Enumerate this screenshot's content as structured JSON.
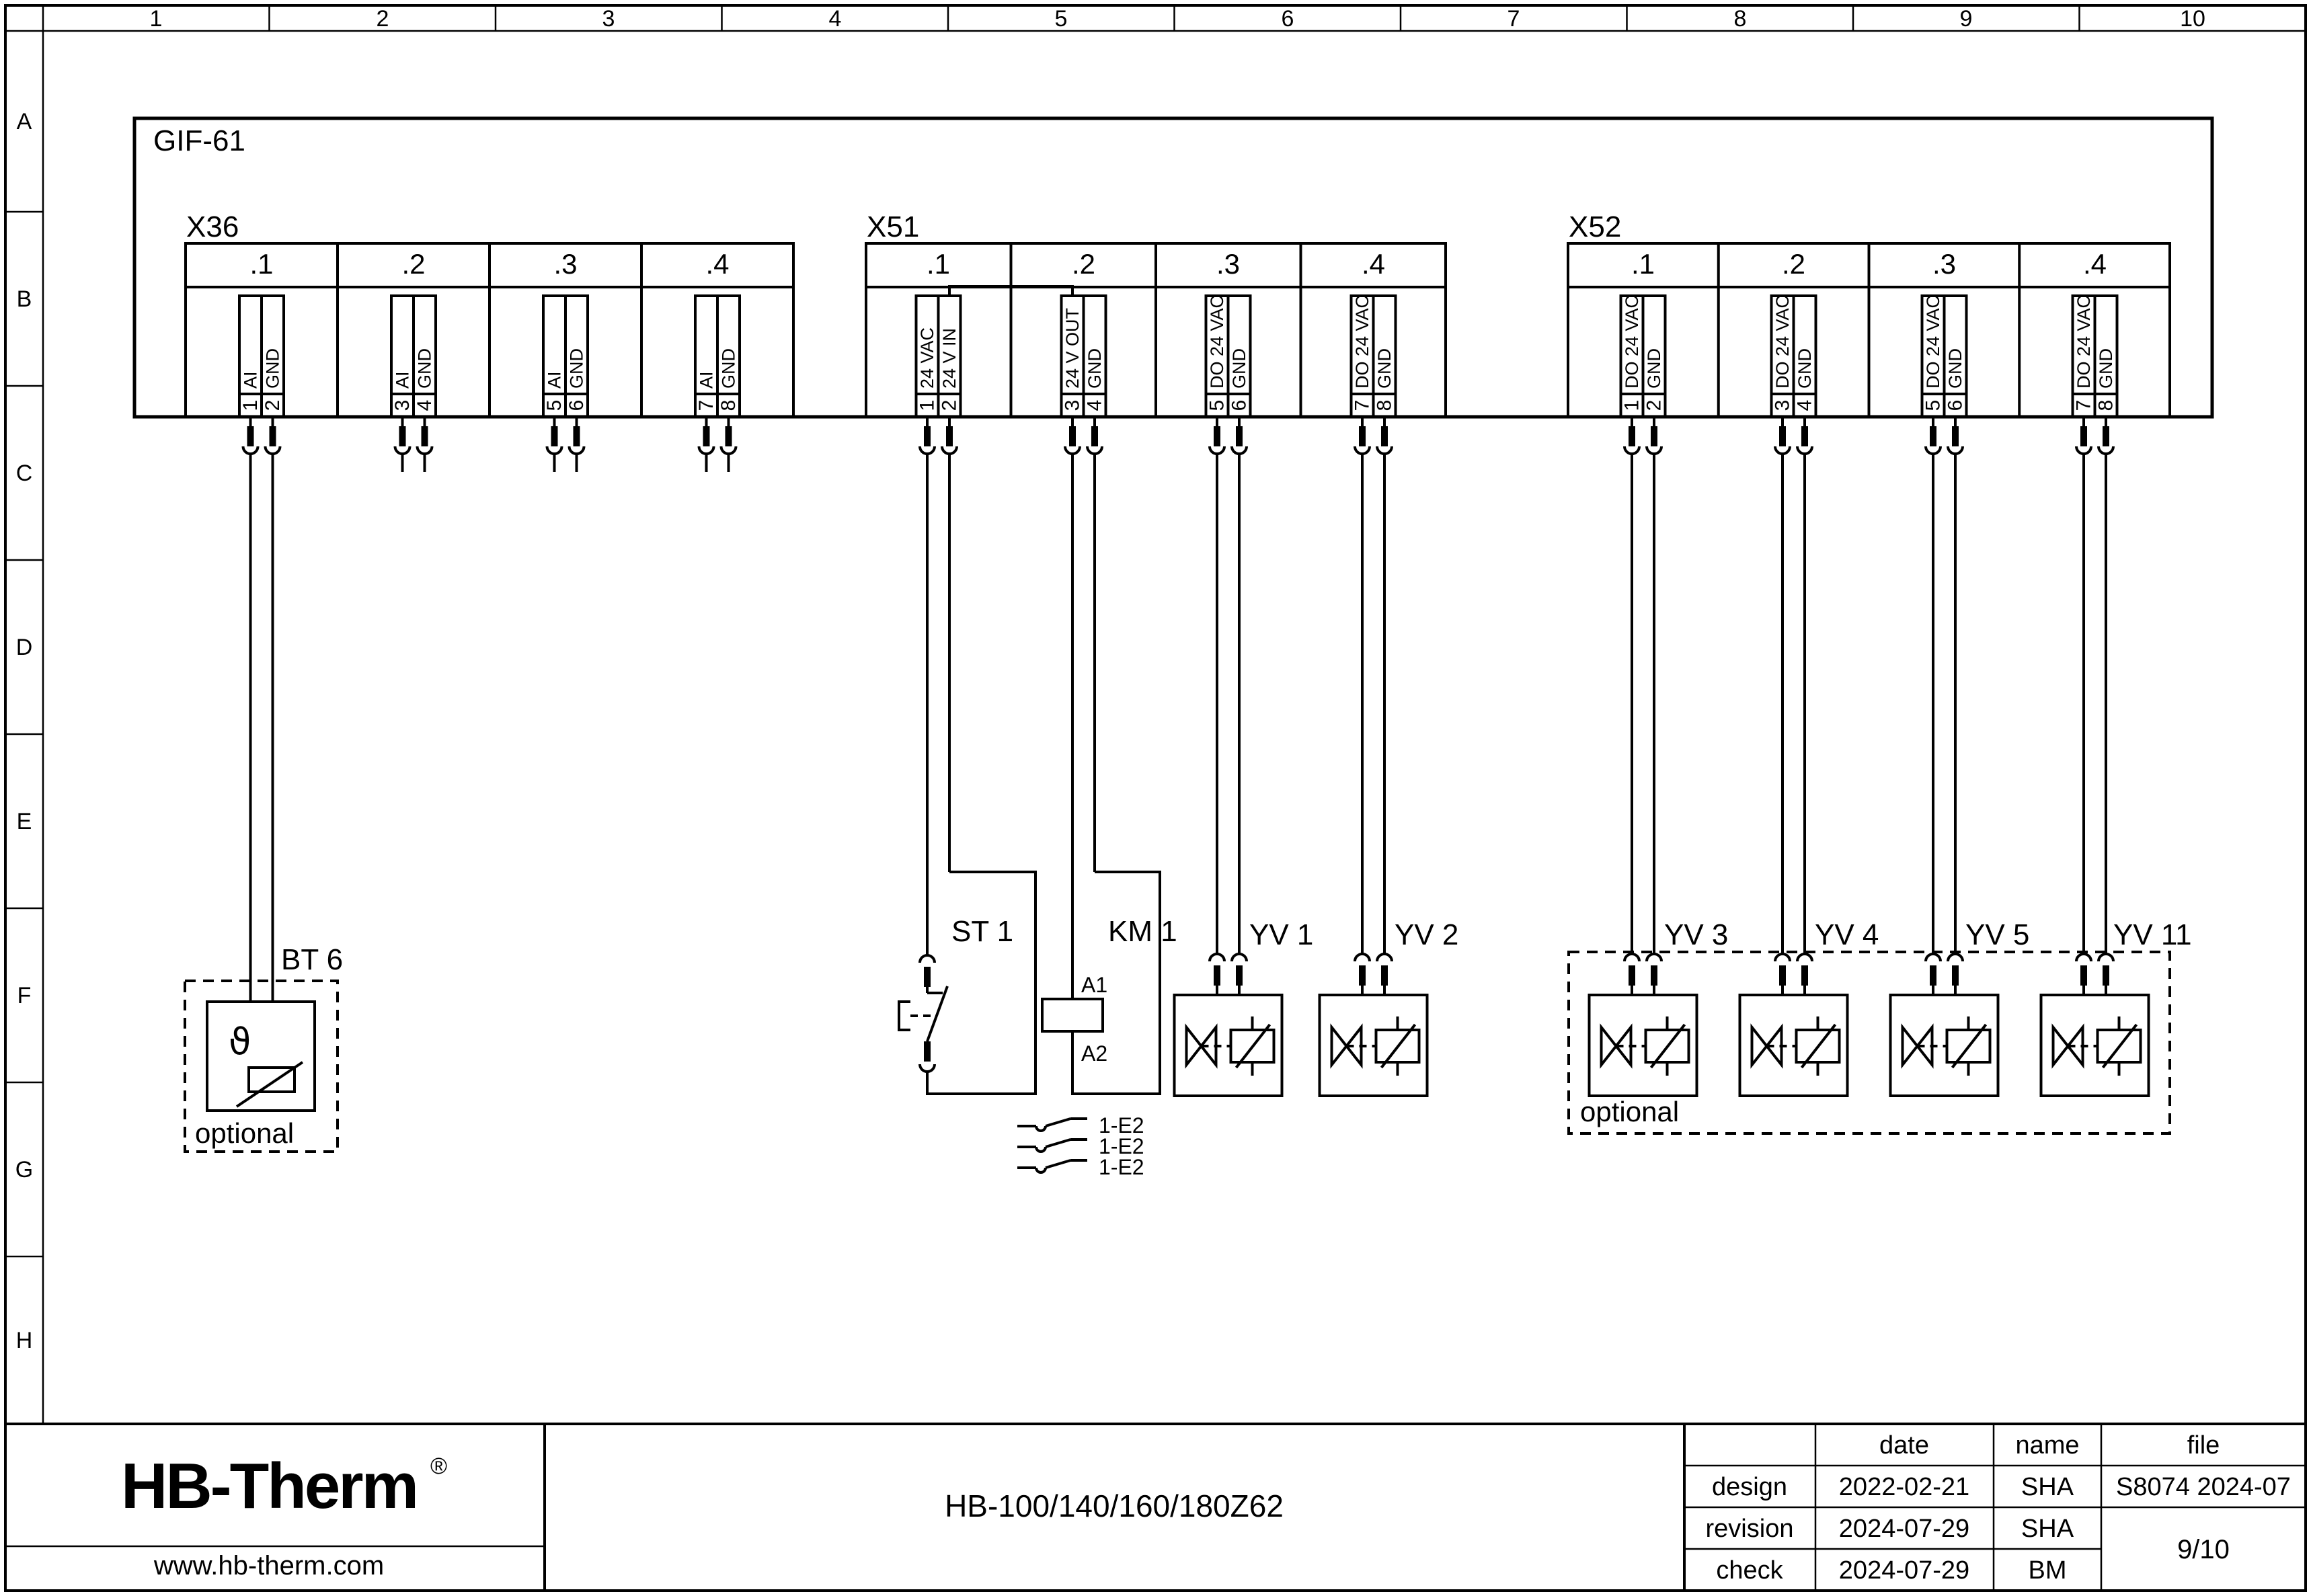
{
  "ruler": {
    "columns": [
      "1",
      "2",
      "3",
      "4",
      "5",
      "6",
      "7",
      "8",
      "9",
      "10"
    ],
    "rows": [
      "A",
      "B",
      "C",
      "D",
      "E",
      "F",
      "G",
      "H"
    ]
  },
  "module": {
    "label": "GIF-61"
  },
  "x36": {
    "label": "X36",
    "cells": [
      {
        "label": ".1"
      },
      {
        "label": ".2"
      },
      {
        "label": ".3"
      },
      {
        "label": ".4"
      }
    ],
    "pins": [
      {
        "no": "1",
        "signal": "AI"
      },
      {
        "no": "2",
        "signal": "GND"
      },
      {
        "no": "3",
        "signal": "AI"
      },
      {
        "no": "4",
        "signal": "GND"
      },
      {
        "no": "5",
        "signal": "AI"
      },
      {
        "no": "6",
        "signal": "GND"
      },
      {
        "no": "7",
        "signal": "AI"
      },
      {
        "no": "8",
        "signal": "GND"
      }
    ]
  },
  "x51": {
    "label": "X51",
    "cells": [
      {
        "label": ".1"
      },
      {
        "label": ".2"
      },
      {
        "label": ".3"
      },
      {
        "label": ".4"
      }
    ],
    "pins": [
      {
        "no": "1",
        "signal": "24 VAC"
      },
      {
        "no": "2",
        "signal": "24 V IN"
      },
      {
        "no": "3",
        "signal": "24 V OUT"
      },
      {
        "no": "4",
        "signal": "GND"
      },
      {
        "no": "5",
        "signal": "DO 24 VAC"
      },
      {
        "no": "6",
        "signal": "GND"
      },
      {
        "no": "7",
        "signal": "DO 24 VAC"
      },
      {
        "no": "8",
        "signal": "GND"
      }
    ]
  },
  "x52": {
    "label": "X52",
    "cells": [
      {
        "label": ".1"
      },
      {
        "label": ".2"
      },
      {
        "label": ".3"
      },
      {
        "label": ".4"
      }
    ],
    "pins": [
      {
        "no": "1",
        "signal": "DO 24 VAC"
      },
      {
        "no": "2",
        "signal": "GND"
      },
      {
        "no": "3",
        "signal": "DO 24 VAC"
      },
      {
        "no": "4",
        "signal": "GND"
      },
      {
        "no": "5",
        "signal": "DO 24 VAC"
      },
      {
        "no": "6",
        "signal": "GND"
      },
      {
        "no": "7",
        "signal": "DO 24 VAC"
      },
      {
        "no": "8",
        "signal": "GND"
      }
    ]
  },
  "components": {
    "bt6": {
      "label": "BT 6",
      "temp_symbol": "ϑ",
      "note": "optional"
    },
    "st1": {
      "label": "ST 1"
    },
    "km1": {
      "label": "KM 1",
      "coil_top": "A1",
      "coil_bottom": "A2"
    },
    "aux_contacts": [
      {
        "ref": "1-E2"
      },
      {
        "ref": "1-E2"
      },
      {
        "ref": "1-E2"
      }
    ],
    "valves": [
      {
        "label": "YV 1"
      },
      {
        "label": "YV 2"
      },
      {
        "label": "YV 3"
      },
      {
        "label": "YV 4"
      },
      {
        "label": "YV 5"
      },
      {
        "label": "YV 11"
      }
    ],
    "optional_group": {
      "note": "optional"
    }
  },
  "title_block": {
    "logo": {
      "text": "HB-Therm",
      "registered": "®",
      "website": "www.hb-therm.com",
      "color": "#16164e"
    },
    "drawing_title": "HB-100/140/160/180Z62",
    "table": {
      "date_header": "date",
      "name_header": "name",
      "file_header": "file",
      "rows": [
        {
          "label": "design",
          "date": "2022-02-21",
          "name": "SHA"
        },
        {
          "label": "revision",
          "date": "2024-07-29",
          "name": "SHA"
        },
        {
          "label": "check",
          "date": "2024-07-29",
          "name": "BM"
        }
      ],
      "file_value": "S8074 2024-07",
      "page": "9/10"
    }
  }
}
